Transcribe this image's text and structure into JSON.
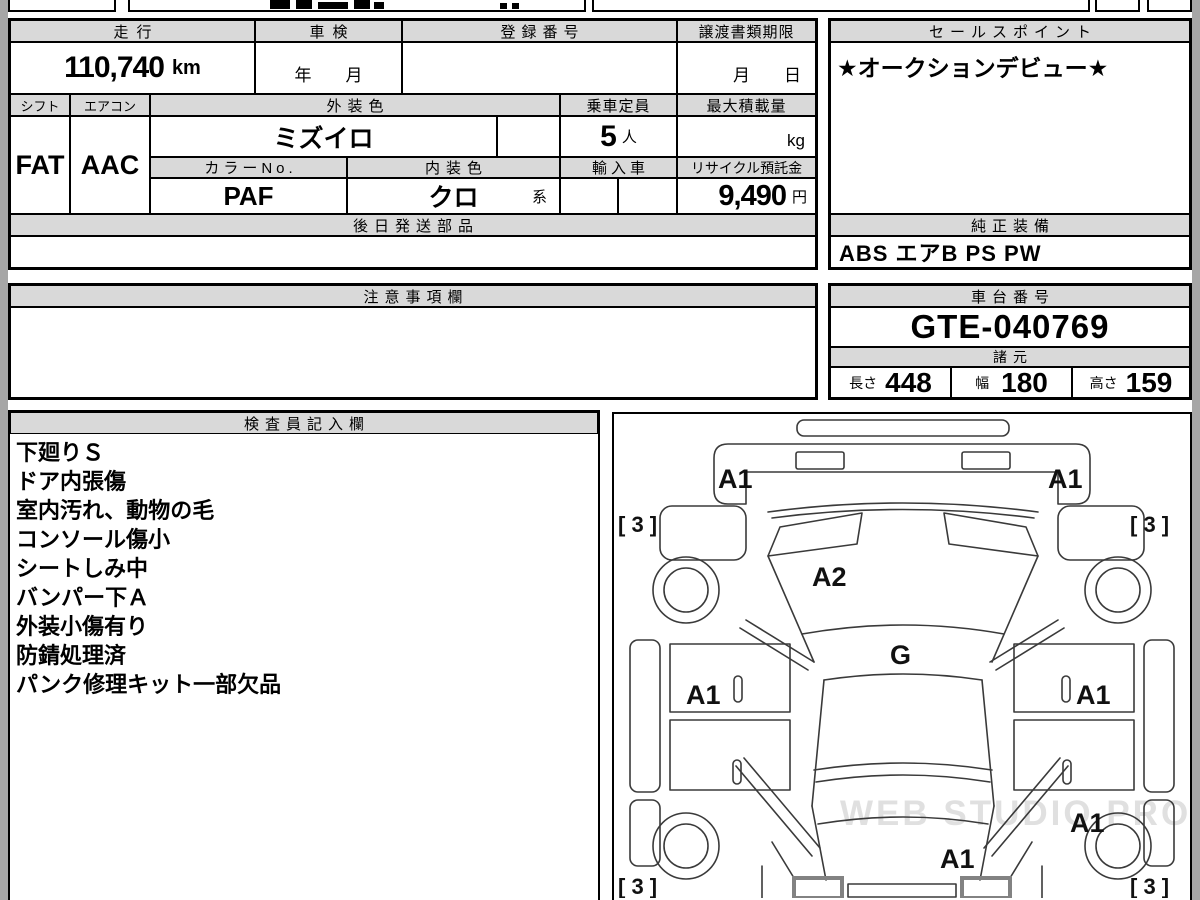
{
  "top_table": {
    "mileage_label": "走行",
    "mileage_value": "110,740",
    "mileage_unit": "km",
    "inspection_label": "車検",
    "inspection_placeholder": "年　　月",
    "registration_label": "登録番号",
    "transfer_label": "譲渡書類期限",
    "transfer_placeholder": "月　　日",
    "shift_label": "シフト",
    "shift_value": "FAT",
    "aircon_label": "エアコン",
    "aircon_value": "AAC",
    "exterior_color_label": "外装色",
    "exterior_color_value": "ミズイロ",
    "capacity_label": "乗車定員",
    "capacity_value": "5",
    "capacity_unit": "人",
    "max_load_label": "最大積載量",
    "max_load_unit": "kg",
    "color_no_label": "カラーNo.",
    "color_no_value": "PAF",
    "interior_color_label": "内装色",
    "interior_color_value": "クロ",
    "interior_color_suffix": "系",
    "import_label": "輸入車",
    "recycle_label": "リサイクル預託金",
    "recycle_value": "9,490",
    "recycle_unit": "円",
    "later_parts_label": "後日発送部品"
  },
  "sales_point": {
    "label": "セールスポイント",
    "text": "★オークションデビュー★"
  },
  "equipment": {
    "label": "純正装備",
    "value": "ABS エアB PS PW"
  },
  "notes": {
    "label": "注意事項欄"
  },
  "chassis": {
    "label": "車台番号",
    "value": "GTE-040769"
  },
  "specs": {
    "label": "諸元",
    "length_label": "長さ",
    "length_value": "448",
    "width_label": "幅",
    "width_value": "180",
    "height_label": "高さ",
    "height_value": "159"
  },
  "inspector": {
    "label": "検査員記入欄",
    "lines": [
      "下廻りＳ",
      "ドア内張傷",
      "室内汚れ、動物の毛",
      "コンソール傷小",
      "シートしみ中",
      "バンパー下Ａ",
      "外装小傷有り",
      "防錆処理済",
      "パンク修理キット一部欠品"
    ]
  },
  "diagram": {
    "marks": {
      "front_left": "A1",
      "front_right": "A1",
      "hood": "A2",
      "cowl": "G",
      "door_left": "A1",
      "door_right": "A1",
      "rear_quarter_right": "A1",
      "rear": "A1",
      "tire_front_left": "[ 3 ]",
      "tire_front_right": "[ 3 ]",
      "tire_rear_left": "[ 3 ]",
      "tire_rear_right": "[ 3 ]"
    },
    "watermark": "WEB STUDIO PRO"
  },
  "colors": {
    "header_bg": "#d9d9d9",
    "border": "#000000",
    "margin_gray": "#a6a6a6",
    "diagram_line": "#3a3a3a",
    "watermark": "#c8c8c8"
  }
}
